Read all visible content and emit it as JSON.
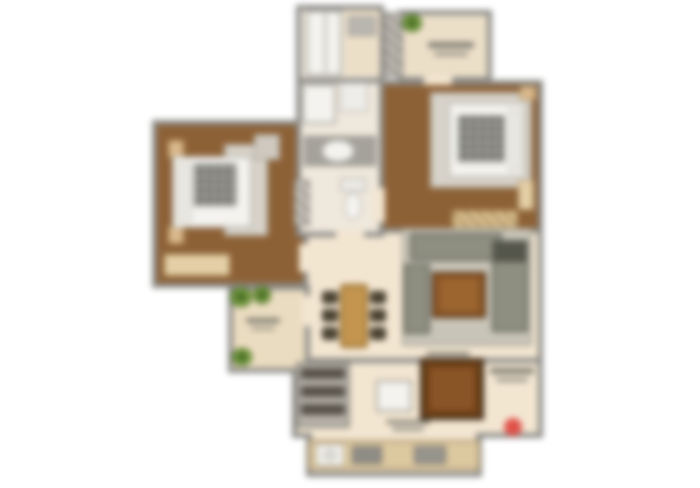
{
  "canvas": {
    "width": 700,
    "height": 488,
    "background": "#ffffff",
    "blur_px": 3.2
  },
  "palette": {
    "wall": "#8b8a86",
    "wood": "#8d6136",
    "cream": "#f3e6d1",
    "balcony": "#eadcc0",
    "bath": "#efe8dc",
    "utility": "#ecdfc8",
    "rug": "#d7d3ca",
    "white": "#f4f3ef",
    "beige": "#e4cfa6",
    "tan": "#d9b98c",
    "sofa": "#8e8f80",
    "sofaDark": "#55564b",
    "woodDark": "#8a5526",
    "tableWood": "#c3954e",
    "chair": "#4d4433",
    "gray": "#a5a29b",
    "red": "#e0524a"
  },
  "rooms": [
    {
      "name": "living-dining-room",
      "x": 298,
      "y": 228,
      "w": 245,
      "h": 142,
      "floor": "cream"
    },
    {
      "name": "kitchen",
      "x": 292,
      "y": 358,
      "w": 251,
      "h": 80,
      "floor": "cream"
    },
    {
      "name": "kitchen-annex",
      "x": 306,
      "y": 436,
      "w": 176,
      "h": 41,
      "floor": "cream"
    },
    {
      "name": "bedroom-1",
      "x": 152,
      "y": 120,
      "w": 156,
      "h": 168,
      "floor": "wood"
    },
    {
      "name": "bedroom-2",
      "x": 372,
      "y": 80,
      "w": 171,
      "h": 153,
      "floor": "wood"
    },
    {
      "name": "bathroom-top",
      "x": 296,
      "y": 5,
      "w": 88,
      "h": 78,
      "floor": "bath"
    },
    {
      "name": "bathroom-main",
      "x": 296,
      "y": 78,
      "w": 88,
      "h": 159,
      "floor": "bath"
    },
    {
      "name": "utility-room",
      "x": 398,
      "y": 10,
      "w": 94,
      "h": 72,
      "floor": "utility"
    },
    {
      "name": "balcony",
      "x": 228,
      "y": 285,
      "w": 82,
      "h": 88,
      "floor": "balcony"
    }
  ],
  "openings": [
    {
      "name": "door-bedroom-1",
      "x": 299,
      "y": 244,
      "w": 12,
      "h": 28
    },
    {
      "name": "door-bathroom",
      "x": 336,
      "y": 230,
      "w": 28,
      "h": 10
    },
    {
      "name": "door-bedroom-2",
      "x": 373,
      "y": 188,
      "w": 12,
      "h": 34
    },
    {
      "name": "door-utility",
      "x": 424,
      "y": 76,
      "w": 28,
      "h": 9
    },
    {
      "name": "door-balcony",
      "x": 302,
      "y": 296,
      "w": 10,
      "h": 30
    },
    {
      "name": "kitchen-pass",
      "x": 312,
      "y": 432,
      "w": 164,
      "h": 12
    }
  ],
  "items": [
    {
      "name": "bedroom-1-rug",
      "x": 224,
      "y": 144,
      "w": 44,
      "h": 92,
      "fill": "rug",
      "border": "#b7b1a5",
      "bw": 2
    },
    {
      "name": "bedside-post",
      "x": 168,
      "y": 140,
      "w": 16,
      "h": 18,
      "fill": "tan",
      "border": "#b08d55",
      "bw": 1
    },
    {
      "name": "bedside-post",
      "x": 168,
      "y": 226,
      "w": 16,
      "h": 18,
      "fill": "tan",
      "border": "#b08d55",
      "bw": 1
    },
    {
      "name": "bed-1",
      "x": 172,
      "y": 156,
      "w": 80,
      "h": 72,
      "fill": "white",
      "border": "#bdb9b1",
      "bw": 2
    },
    {
      "name": "bed-1-pillow",
      "x": 177,
      "y": 162,
      "w": 15,
      "h": 60,
      "fill": "#e9e7e1",
      "border": "#ccc8be",
      "bw": 1
    },
    {
      "name": "bed-1-blanket",
      "type": "plaid",
      "x": 194,
      "y": 164,
      "w": 42,
      "h": 42
    },
    {
      "name": "cabinet",
      "x": 254,
      "y": 134,
      "w": 26,
      "h": 26,
      "fill": "#cfc9bf",
      "border": "#a09a8e",
      "bw": 1
    },
    {
      "name": "dresser",
      "x": 164,
      "y": 254,
      "w": 66,
      "h": 22,
      "fill": "beige",
      "border": "#b49467",
      "bw": 1
    },
    {
      "name": "bedroom-2-rug",
      "x": 430,
      "y": 92,
      "w": 102,
      "h": 96,
      "fill": "rug",
      "border": "#b7b1a5",
      "bw": 2
    },
    {
      "name": "bed-2",
      "x": 448,
      "y": 102,
      "w": 78,
      "h": 76,
      "fill": "white",
      "border": "#bdb9b1",
      "bw": 2
    },
    {
      "name": "bed-2-pillow",
      "x": 508,
      "y": 108,
      "w": 15,
      "h": 64,
      "fill": "#e9e7e1",
      "border": "#ccc8be",
      "bw": 1
    },
    {
      "name": "bed-2-blanket",
      "type": "plaid",
      "x": 458,
      "y": 116,
      "w": 46,
      "h": 46
    },
    {
      "name": "nightstand",
      "x": 520,
      "y": 86,
      "w": 16,
      "h": 14,
      "fill": "tan",
      "border": "#b08d55",
      "bw": 1
    },
    {
      "name": "dresser",
      "x": 518,
      "y": 180,
      "w": 16,
      "h": 30,
      "fill": "beige",
      "border": "#b49467",
      "bw": 1
    },
    {
      "name": "wardrobe",
      "type": "hatch",
      "x": 452,
      "y": 210,
      "w": 66,
      "h": 18,
      "fill": "#dcc08e",
      "border": "#a3854f",
      "bw": 1
    },
    {
      "name": "bath-floor-strip",
      "x": 344,
      "y": 10,
      "w": 36,
      "h": 66,
      "fill": "utility"
    },
    {
      "name": "shower",
      "x": 306,
      "y": 10,
      "w": 36,
      "h": 66,
      "fill": "white",
      "border": "#a7a49e",
      "bw": 2
    },
    {
      "name": "shower-door",
      "x": 324,
      "y": 13,
      "w": 3,
      "h": 60,
      "fill": "#c7c4bd"
    },
    {
      "name": "washbasin-unit",
      "x": 348,
      "y": 16,
      "w": 28,
      "h": 20,
      "fill": "#b9b6b0",
      "border": "#918e88",
      "bw": 1
    },
    {
      "name": "washing-machine",
      "x": 302,
      "y": 84,
      "w": 34,
      "h": 40,
      "fill": "white",
      "border": "#a7a49e",
      "bw": 2
    },
    {
      "name": "bath-fixture",
      "x": 340,
      "y": 82,
      "w": 28,
      "h": 30,
      "fill": "#eeede9",
      "border": "#a7a49e",
      "bw": 1
    },
    {
      "name": "vanity-counter",
      "x": 304,
      "y": 136,
      "w": 72,
      "h": 30,
      "fill": "gray",
      "border": "#817e78",
      "bw": 1
    },
    {
      "name": "wash-basin",
      "x": 322,
      "y": 140,
      "w": 32,
      "h": 22,
      "fill": "white",
      "border": "#b5b2aa",
      "bw": 1,
      "radius": "50%"
    },
    {
      "name": "shaft",
      "type": "hatch",
      "x": 294,
      "y": 180,
      "w": 16,
      "h": 46,
      "fill": "#c4c1ba",
      "border": "#8b8a86",
      "bw": 1
    },
    {
      "name": "toilet-tank",
      "x": 340,
      "y": 178,
      "w": 26,
      "h": 14,
      "fill": "#eceae5",
      "border": "#a7a49e",
      "bw": 1
    },
    {
      "name": "toilet-bowl",
      "x": 344,
      "y": 192,
      "w": 18,
      "h": 28,
      "fill": "white",
      "border": "#a7a49e",
      "bw": 1,
      "radius": "50%"
    },
    {
      "name": "duct",
      "type": "hatch",
      "x": 384,
      "y": 12,
      "w": 18,
      "h": 66,
      "fill": "#bdbab4",
      "border": "#8b8a86",
      "bw": 1
    },
    {
      "name": "plant",
      "type": "plant",
      "x": 402,
      "y": 14,
      "w": 20,
      "h": 18
    },
    {
      "name": "illegible-room-label",
      "type": "smudge",
      "x": 428,
      "y": 40,
      "w": 46,
      "h": 18
    },
    {
      "name": "plant",
      "type": "plant",
      "x": 230,
      "y": 287,
      "w": 22,
      "h": 20
    },
    {
      "name": "plant",
      "type": "plant",
      "x": 253,
      "y": 286,
      "w": 18,
      "h": 18
    },
    {
      "name": "plant",
      "type": "plant",
      "x": 232,
      "y": 348,
      "w": 20,
      "h": 18
    },
    {
      "name": "illegible-room-label",
      "type": "smudge",
      "x": 246,
      "y": 316,
      "w": 34,
      "h": 16
    },
    {
      "name": "living-rug",
      "x": 402,
      "y": 228,
      "w": 130,
      "h": 118,
      "fill": "#c8c4b8",
      "border": "#aaa69a",
      "bw": 2
    },
    {
      "name": "sofa-back",
      "x": 410,
      "y": 233,
      "w": 92,
      "h": 28,
      "fill": "sofa",
      "border": "#63645a",
      "bw": 2
    },
    {
      "name": "sofa-right-arm",
      "x": 492,
      "y": 240,
      "w": 36,
      "h": 92,
      "fill": "sofa",
      "border": "#63645a",
      "bw": 2
    },
    {
      "name": "sofa-left-arm",
      "x": 404,
      "y": 264,
      "w": 26,
      "h": 70,
      "fill": "sofa",
      "border": "#63645a",
      "bw": 2
    },
    {
      "name": "sofa-cushion",
      "x": 494,
      "y": 242,
      "w": 32,
      "h": 20,
      "fill": "sofaDark"
    },
    {
      "name": "coffee-table",
      "x": 432,
      "y": 272,
      "w": 54,
      "h": 46,
      "fill": "woodDark",
      "border": "#4c2e14",
      "bw": 2
    },
    {
      "name": "coffee-table-top",
      "x": 440,
      "y": 279,
      "w": 38,
      "h": 32,
      "fill": "#9c6530"
    },
    {
      "name": "illegible-room-label",
      "type": "smudge",
      "x": 426,
      "y": 350,
      "w": 44,
      "h": 14
    },
    {
      "name": "dining-chair",
      "x": 322,
      "y": 291,
      "w": 16,
      "h": 13,
      "fill": "chair",
      "border": "#332d20",
      "bw": 1,
      "radius": 3
    },
    {
      "name": "dining-chair",
      "x": 322,
      "y": 309,
      "w": 16,
      "h": 13,
      "fill": "chair",
      "border": "#332d20",
      "bw": 1,
      "radius": 3
    },
    {
      "name": "dining-chair",
      "x": 322,
      "y": 327,
      "w": 16,
      "h": 13,
      "fill": "chair",
      "border": "#332d20",
      "bw": 1,
      "radius": 3
    },
    {
      "name": "dining-chair",
      "x": 370,
      "y": 291,
      "w": 16,
      "h": 13,
      "fill": "chair",
      "border": "#332d20",
      "bw": 1,
      "radius": 3
    },
    {
      "name": "dining-chair",
      "x": 370,
      "y": 309,
      "w": 16,
      "h": 13,
      "fill": "chair",
      "border": "#332d20",
      "bw": 1,
      "radius": 3
    },
    {
      "name": "dining-chair",
      "x": 370,
      "y": 327,
      "w": 16,
      "h": 13,
      "fill": "chair",
      "border": "#332d20",
      "bw": 1,
      "radius": 3
    },
    {
      "name": "dining-table",
      "x": 340,
      "y": 284,
      "w": 28,
      "h": 64,
      "fill": "tableWood",
      "border": "#8a6226",
      "bw": 2,
      "radius": 4
    },
    {
      "name": "storage-rack",
      "x": 296,
      "y": 362,
      "w": 54,
      "h": 66,
      "fill": "#b5b1a8",
      "border": "#88847c",
      "bw": 2
    },
    {
      "name": "rack-items",
      "x": 301,
      "y": 368,
      "w": 44,
      "h": 11,
      "fill": "#57524a"
    },
    {
      "name": "rack-items",
      "x": 301,
      "y": 386,
      "w": 44,
      "h": 11,
      "fill": "#57524a"
    },
    {
      "name": "rack-items",
      "x": 301,
      "y": 404,
      "w": 44,
      "h": 11,
      "fill": "#57524a"
    },
    {
      "name": "kitchen-island",
      "x": 376,
      "y": 380,
      "w": 36,
      "h": 32,
      "fill": "white",
      "border": "#a19e97",
      "bw": 2
    },
    {
      "name": "counter-unit",
      "x": 420,
      "y": 358,
      "w": 64,
      "h": 62,
      "fill": "#6f4118",
      "border": "#39291a",
      "bw": 3
    },
    {
      "name": "counter-unit-top",
      "x": 430,
      "y": 368,
      "w": 44,
      "h": 42,
      "fill": "woodDark"
    },
    {
      "name": "illegible-room-label",
      "type": "smudge",
      "x": 386,
      "y": 418,
      "w": 44,
      "h": 14
    },
    {
      "name": "kitchen-counter",
      "x": 308,
      "y": 440,
      "w": 172,
      "h": 30,
      "fill": "#ddc9a0",
      "border": "#a8906a",
      "bw": 2
    },
    {
      "name": "sink",
      "x": 316,
      "y": 444,
      "w": 28,
      "h": 22,
      "fill": "white",
      "border": "#9f9c95",
      "bw": 1
    },
    {
      "name": "sink-bowl",
      "x": 322,
      "y": 448,
      "w": 16,
      "h": 14,
      "fill": "#d9d7d2",
      "radius": "50%"
    },
    {
      "name": "hob",
      "x": 352,
      "y": 446,
      "w": 30,
      "h": 18,
      "fill": "#8f8c86",
      "border": "#6b6862",
      "bw": 1
    },
    {
      "name": "appliance",
      "x": 414,
      "y": 446,
      "w": 32,
      "h": 18,
      "fill": "#97948d",
      "border": "#6b6862",
      "bw": 1
    },
    {
      "name": "illegible-room-label",
      "type": "smudge",
      "x": 490,
      "y": 366,
      "w": 44,
      "h": 18
    },
    {
      "name": "entry-marker",
      "x": 504,
      "y": 418,
      "w": 18,
      "h": 18,
      "fill": "red",
      "radius": "50%"
    }
  ]
}
